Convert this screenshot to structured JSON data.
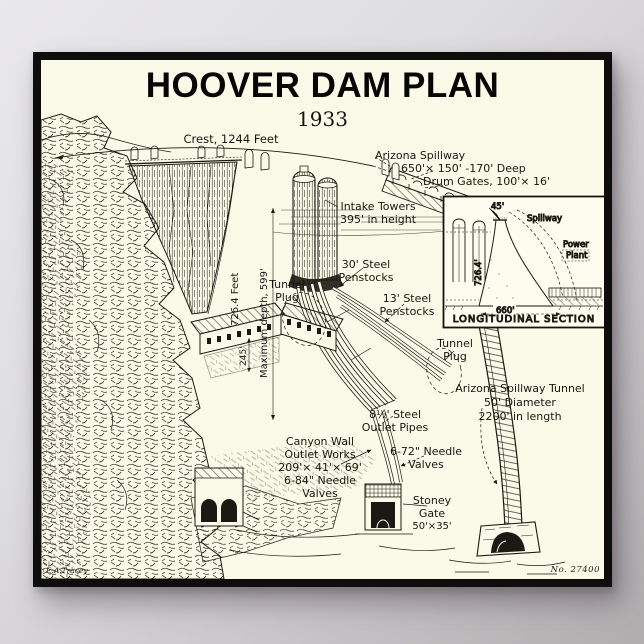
{
  "poster": {
    "title": "HOOVER DAM PLAN",
    "year": "1933",
    "plate_number": "No. 27400",
    "signature": "E.A.Tracey"
  },
  "labels": {
    "crest": "Crest, 1244 Feet",
    "arizona_spillway": [
      "Arizona Spillway",
      "650'× 150' -170' Deep",
      "Drum Gates, 100'× 16'"
    ],
    "intake_towers": [
      "Intake Towers",
      "395' in height"
    ],
    "penstocks_30": [
      "30' Steel",
      "Penstocks"
    ],
    "penstocks_13": [
      "13' Steel",
      "Penstocks"
    ],
    "tunnel_plug_upper": [
      "Tunnel",
      "Plug"
    ],
    "tunnel_plug_lower": [
      "Tunnel",
      "Plug"
    ],
    "dam_height": "726.4 Feet",
    "max_depth": "Maximum depth, 599'",
    "powerhouse_length": "245'",
    "spillway_tunnel": [
      "Arizona Spillway  Tunnel",
      "50' Diameter",
      "2200' in length"
    ],
    "outlet_pipes": [
      "8½' Steel",
      "Outlet Pipes"
    ],
    "needle_valves_72": [
      "6-72\" Needle",
      "Valves"
    ],
    "canyon_wall_outlet": [
      "Canyon Wall",
      "Outlet Works",
      "209'× 41'× 69'",
      "6-84\" Needle",
      "Valves"
    ],
    "stoney_gate": [
      "Stoney",
      "Gate",
      "50'×35'"
    ]
  },
  "inset": {
    "caption": "LONGITUDINAL SECTION",
    "height_45": "45'",
    "width_660": "660'",
    "height_726": "726.4'",
    "spillway": "Spillway",
    "power_plant": [
      "Power",
      "Plant"
    ]
  },
  "colors": {
    "paper": "#fbfae9",
    "ink": "#1b1913",
    "frame": "#0d0d0c"
  }
}
